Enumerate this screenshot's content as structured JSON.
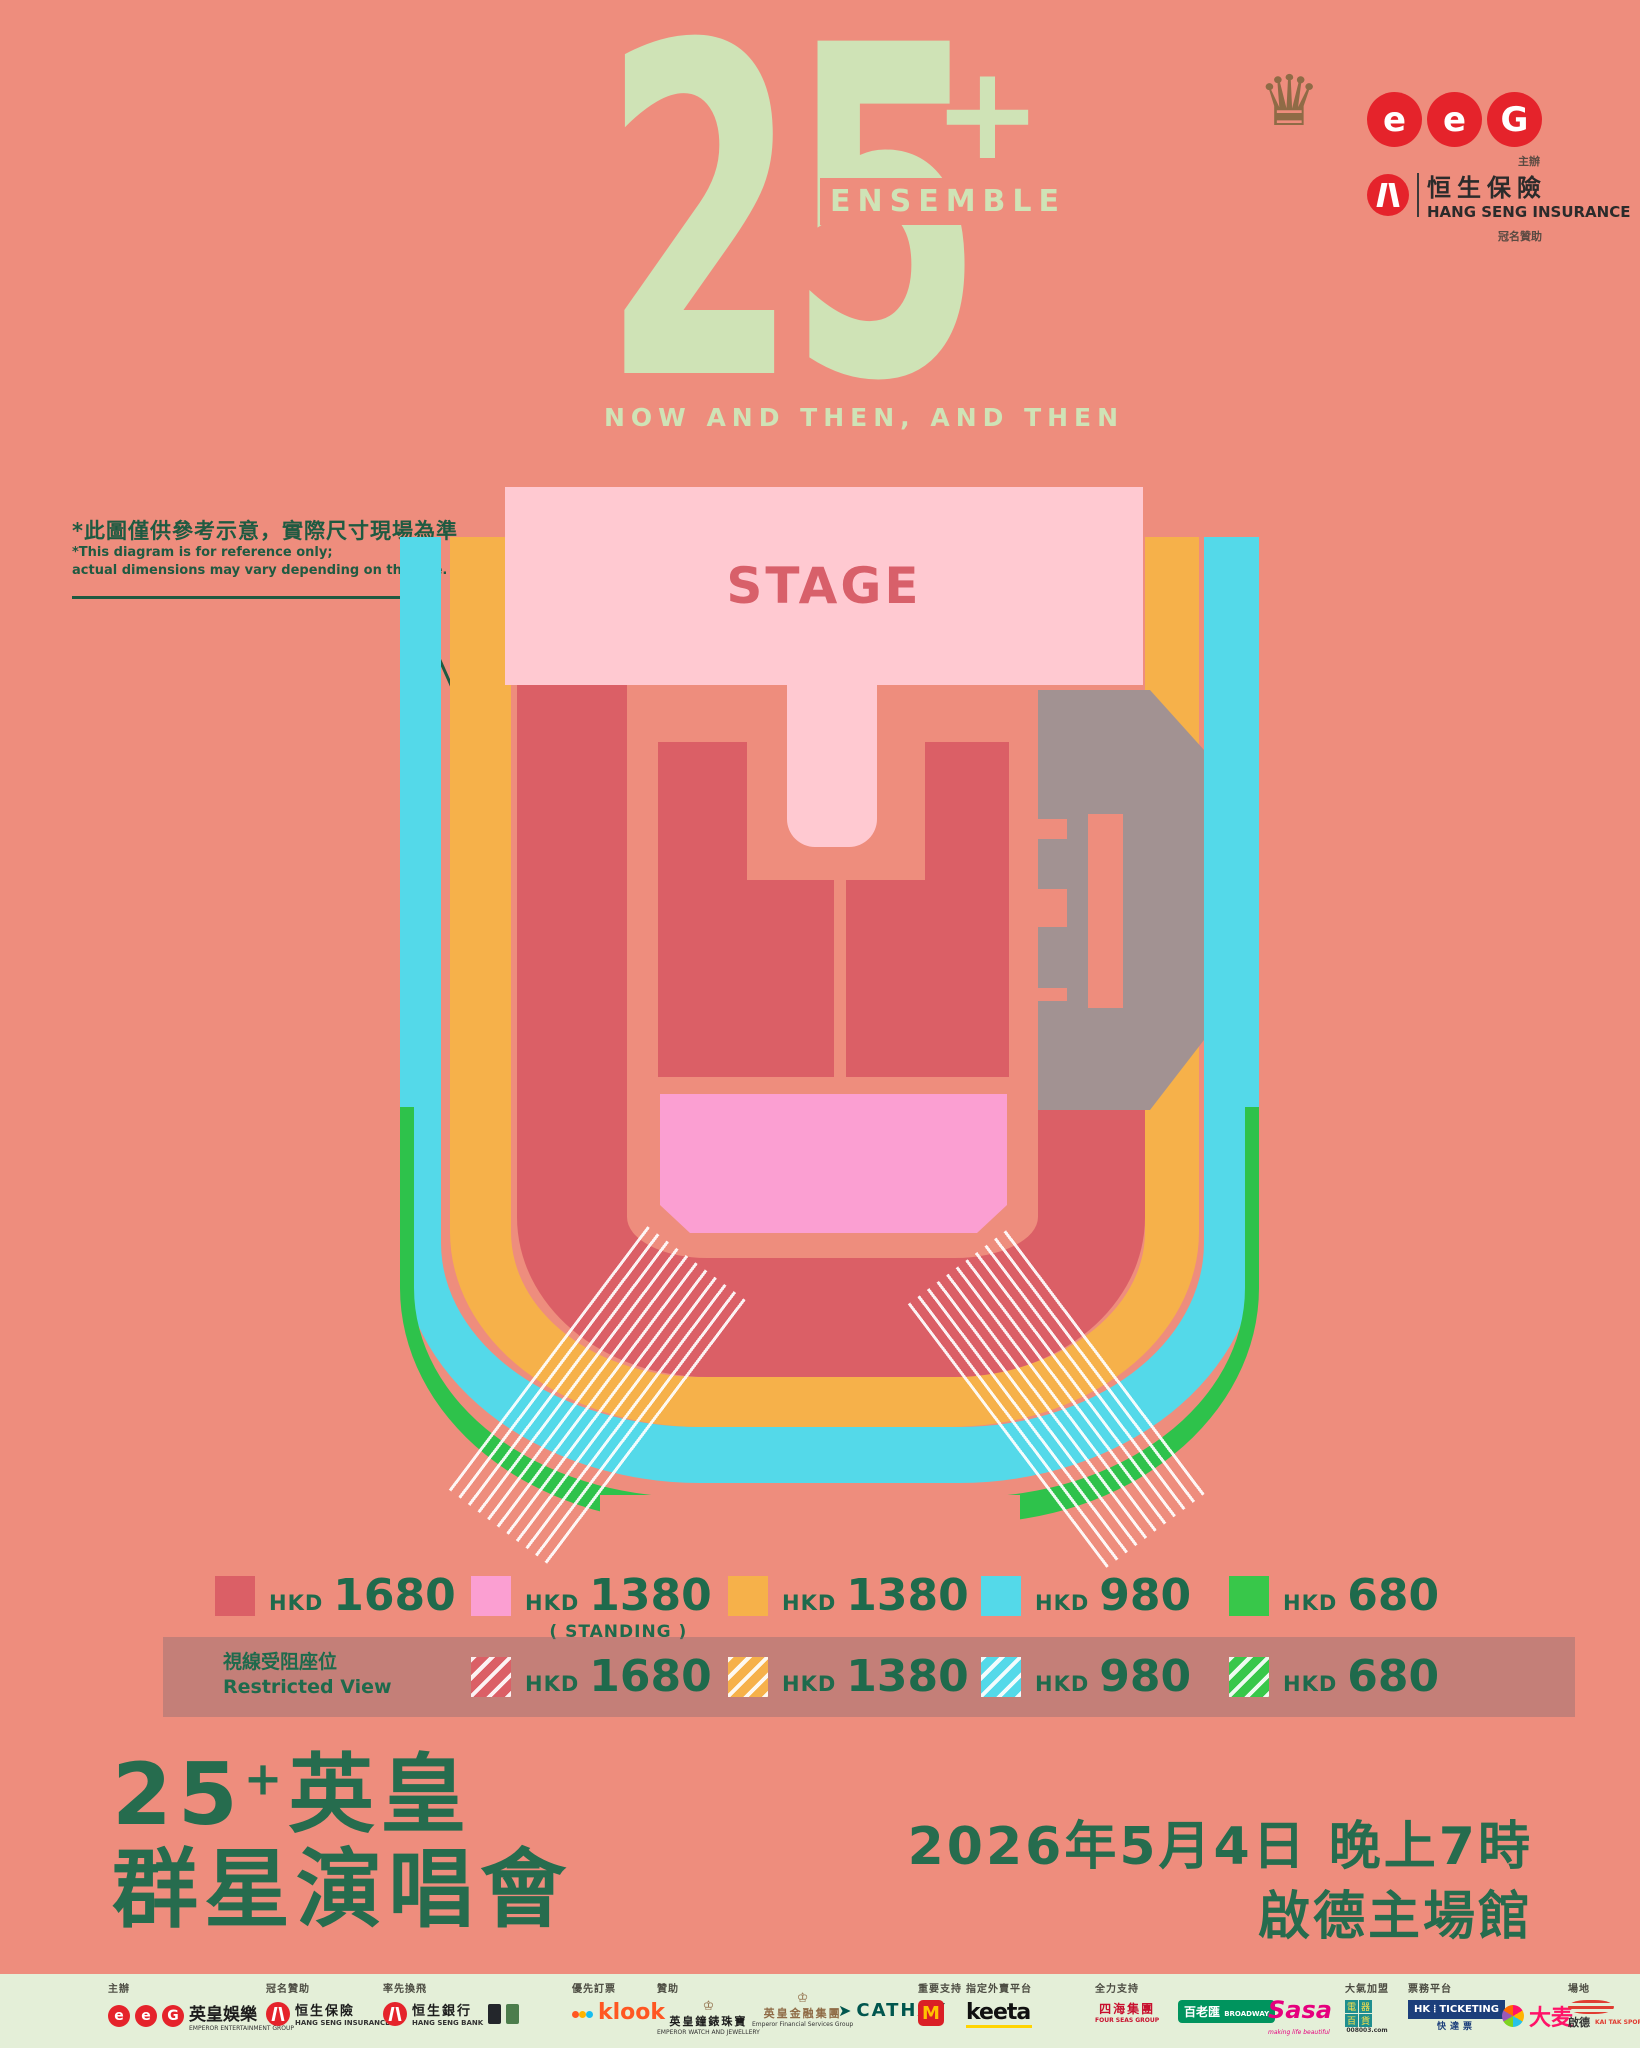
{
  "header": {
    "numeral": "25",
    "plus": "+",
    "ensemble": "ENSEMBLE",
    "subtitle": "NOW AND THEN, AND THEN",
    "organizer_label": "主辦",
    "title_sponsor_label": "冠名贊助",
    "eeg_letters": [
      "e",
      "e",
      "G"
    ],
    "hsi_zh": "恒生保險",
    "hsi_en": "HANG SENG INSURANCE"
  },
  "disclaimer": {
    "zh": "*此圖僅供參考示意，實際尺寸現場為準",
    "en1": "*This diagram is for reference only;",
    "en2": "actual dimensions may vary depending on the site."
  },
  "stage": {
    "label": "STAGE"
  },
  "legend": {
    "hkd": "HKD",
    "row1": [
      {
        "price": "1680",
        "color": "#db5f66"
      },
      {
        "price": "1380",
        "color": "#fb9fd2",
        "note": "( STANDING )"
      },
      {
        "price": "1380",
        "color": "#f6b14a"
      },
      {
        "price": "980",
        "color": "#54d9e9"
      },
      {
        "price": "680",
        "color": "#38c74a"
      }
    ],
    "restricted_zh": "視線受阻座位",
    "restricted_en": "Restricted View",
    "row2": [
      {
        "price": "1680",
        "color": "#db5f66"
      },
      {
        "price": "1380",
        "color": "#f6b14a"
      },
      {
        "price": "980",
        "color": "#54d9e9"
      },
      {
        "price": "680",
        "color": "#38c74a"
      }
    ]
  },
  "event": {
    "t25": "25",
    "tplus": "+",
    "tzh1": "英皇",
    "tzh2": "群星演唱會",
    "datetime": "2026年5月4日 晚上7時",
    "venue": "啟德主場館"
  },
  "footer": {
    "organizer_label": "主辦",
    "eeg_letters": [
      "e",
      "e",
      "G"
    ],
    "organizer_zh": "英皇娛樂",
    "organizer_en": "EMPEROR ENTERTAINMENT GROUP",
    "title_sponsor_label": "冠名贊助",
    "hsi_zh": "恒生保險",
    "hsi_en": "HANG SENG INSURANCE",
    "bank_label": "率先換飛",
    "hsb_zh": "恒生銀行",
    "hsb_en": "HANG SENG BANK",
    "priority_label": "優先訂票",
    "klook": "klook",
    "sponsor_label": "贊助",
    "watch_zh": "英皇鐘錶珠寶",
    "watch_en": "EMPEROR WATCH AND JEWELLERY",
    "finance_zh": "英皇金融集團",
    "finance_en": "Emperor Financial Services Group",
    "cathay": "CATHAY",
    "support_label": "重要支持",
    "mcd_m": "M",
    "delivery_label": "指定外賣平台",
    "keeta": "keeta",
    "full_support_label": "全力支持",
    "fourseas_zh": "四海集團",
    "fourseas_en": "FOUR SEAS GROUP",
    "broadway_zh": "百老匯",
    "broadway_en": "BROADWAY",
    "sasa": "Sasa",
    "sasa_tag": "making life beautiful",
    "joining_label": "大氣加盟",
    "appliance_chars": [
      "電",
      "器",
      "百",
      "貨"
    ],
    "appliance_url": "008003.com",
    "ticketing_label": "票務平台",
    "hkt_hk": "HK",
    "hkt_ticketing": "TICKETING",
    "hkt_zh": "快達票",
    "damai": "大麦",
    "venue_label": "場地",
    "kaitak_zh": "啟德",
    "kaitak_en": "KAI TAK SPORTS PARK"
  },
  "colors": {
    "background": "#ee8d7d",
    "logo_green": "#cfe3b6",
    "dark_green": "#1f6a4c",
    "stage_pink": "#ffc9d1",
    "standing_pink": "#fb9fd2",
    "seat_red": "#db5f66",
    "seat_orange": "#f6b14a",
    "seat_cyan": "#54d9e9",
    "seat_green": "#38c74a",
    "tower_gray": "#a29292",
    "eeg_red": "#e5232b",
    "footer_bg": "#e4efd8"
  }
}
